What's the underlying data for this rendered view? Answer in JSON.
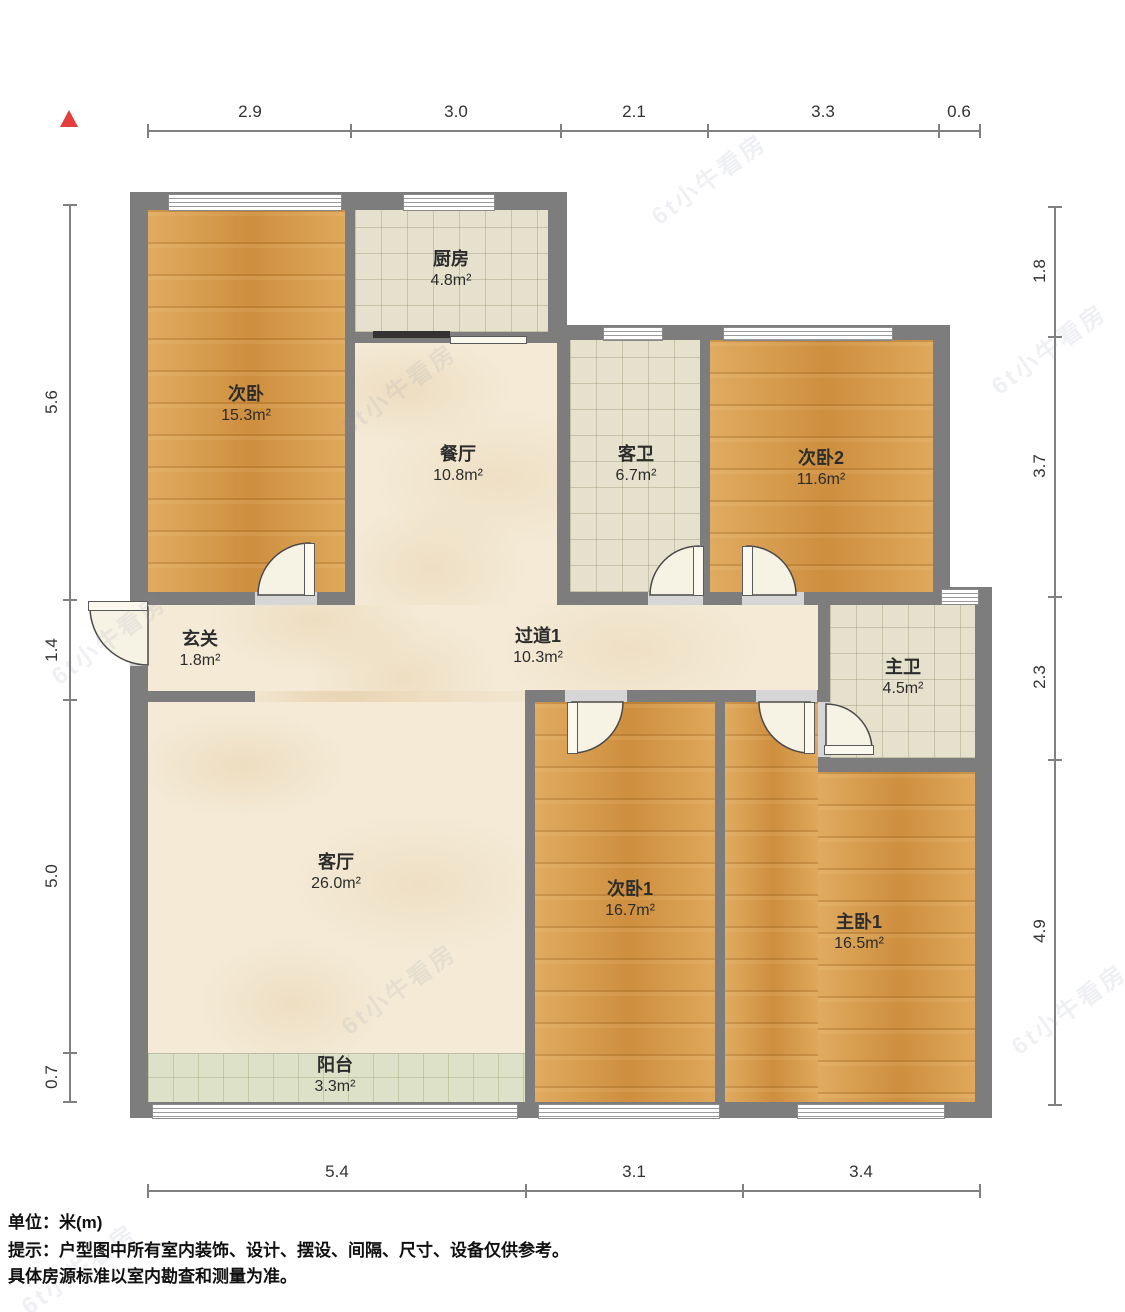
{
  "rooms": {
    "ciwo": {
      "name": "次卧",
      "area": "15.3m²"
    },
    "chufang": {
      "name": "厨房",
      "area": "4.8m²"
    },
    "canting": {
      "name": "餐厅",
      "area": "10.8m²"
    },
    "kewei": {
      "name": "客卫",
      "area": "6.7m²"
    },
    "ciwo2": {
      "name": "次卧2",
      "area": "11.6m²"
    },
    "xuanguan": {
      "name": "玄关",
      "area": "1.8m²"
    },
    "guodao1": {
      "name": "过道1",
      "area": "10.3m²"
    },
    "zhuwei": {
      "name": "主卫",
      "area": "4.5m²"
    },
    "keting": {
      "name": "客厅",
      "area": "26.0m²"
    },
    "ciwo1": {
      "name": "次卧1",
      "area": "16.7m²"
    },
    "zhuwo1": {
      "name": "主卧1",
      "area": "16.5m²"
    },
    "yangtai": {
      "name": "阳台",
      "area": "3.3m²"
    }
  },
  "dims": {
    "top": [
      "2.9",
      "3.0",
      "2.1",
      "3.3",
      "0.6"
    ],
    "left": [
      "5.6",
      "1.4",
      "5.0",
      "0.7"
    ],
    "right": [
      "1.8",
      "3.7",
      "2.3",
      "4.9"
    ],
    "bottom": [
      "5.4",
      "3.1",
      "3.4"
    ]
  },
  "footer": {
    "unit": "单位：米(m)",
    "tip1": "提示：户型图中所有室内装饰、设计、摆设、间隔、尺寸、设备仅供参考。",
    "tip2": "具体房源标准以室内勘查和测量为准。"
  },
  "watermark": {
    "text": "6t小牛看房"
  },
  "colors": {
    "wall": "#7d7d7d",
    "wood_floor": "#d89946",
    "marble_floor": "#f4ead6",
    "tile_floor": "#e5e1cc",
    "balcony_floor": "#dde1c7",
    "north_arrow": "#e43d3d"
  }
}
